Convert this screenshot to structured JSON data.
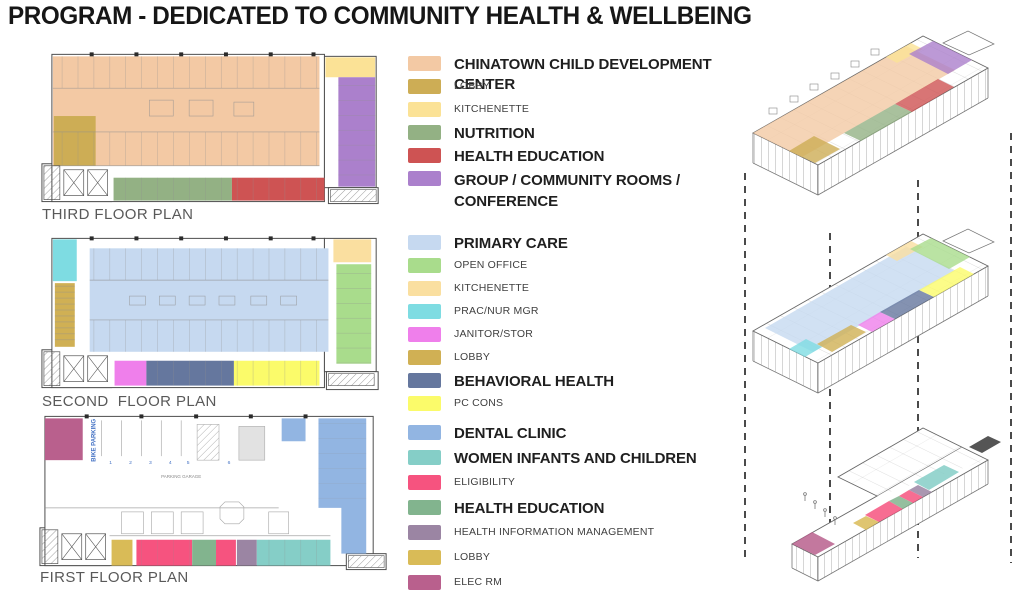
{
  "title": "PROGRAM - DEDICATED TO COMMUNITY HEALTH & WELLBEING",
  "floor_plans": [
    {
      "id": "third",
      "label": "THIRD FLOOR PLAN"
    },
    {
      "id": "second",
      "label": "SECOND  FLOOR PLAN"
    },
    {
      "id": "first",
      "label": "FIRST FLOOR PLAN",
      "annotations": {
        "bike_parking": "BIKE PARKING",
        "parking_garage": "PARKING GARAGE",
        "stall_numbers": [
          "1",
          "2",
          "3",
          "4",
          "5",
          "6"
        ]
      }
    }
  ],
  "legend": {
    "groups": [
      {
        "items": [
          {
            "label": "CHINATOWN CHILD DEVELOPMENT CENTER",
            "color": "#F3C9A4",
            "emphasis": "bold"
          },
          {
            "label": "LOBBY",
            "color": "#CDAD55",
            "emphasis": "small"
          },
          {
            "label": "KITCHENETTE",
            "color": "#FBE296",
            "emphasis": "small"
          },
          {
            "label": "NUTRITION",
            "color": "#93B184",
            "emphasis": "bold"
          },
          {
            "label": "HEALTH EDUCATION",
            "color": "#CE5353",
            "emphasis": "bold"
          },
          {
            "label": "GROUP / COMMUNITY ROOMS /\nCONFERENCE",
            "color": "#AB80CC",
            "emphasis": "bold"
          }
        ]
      },
      {
        "items": [
          {
            "label": "PRIMARY CARE",
            "color": "#C6D9F0",
            "emphasis": "bold"
          },
          {
            "label": "OPEN OFFICE",
            "color": "#A9DC8C",
            "emphasis": "small"
          },
          {
            "label": "KITCHENETTE",
            "color": "#FADFA0",
            "emphasis": "small"
          },
          {
            "label": "PRAC/NUR MGR",
            "color": "#7EDCE2",
            "emphasis": "small"
          },
          {
            "label": "JANITOR/STOR",
            "color": "#EF7FEB",
            "emphasis": "small"
          },
          {
            "label": "LOBBY",
            "color": "#D0B054",
            "emphasis": "small"
          },
          {
            "label": "BEHAVIORAL HEALTH",
            "color": "#65779E",
            "emphasis": "bold"
          },
          {
            "label": "PC CONS",
            "color": "#FBFB6A",
            "emphasis": "small"
          }
        ]
      },
      {
        "items": [
          {
            "label": "DENTAL CLINIC",
            "color": "#92B5E2",
            "emphasis": "bold"
          },
          {
            "label": "WOMEN INFANTS AND CHILDREN",
            "color": "#85CEC7",
            "emphasis": "bold"
          },
          {
            "label": "ELIGIBILITY",
            "color": "#F6537F",
            "emphasis": "small"
          },
          {
            "label": "HEALTH EDUCATION",
            "color": "#82B48E",
            "emphasis": "bold"
          },
          {
            "label": "HEALTH INFORMATION MANAGEMENT",
            "color": "#9B85A3",
            "emphasis": "small"
          },
          {
            "label": "LOBBY",
            "color": "#D9BB57",
            "emphasis": "small"
          },
          {
            "label": "ELEC RM",
            "color": "#B9608D",
            "emphasis": "small"
          }
        ]
      }
    ]
  }
}
